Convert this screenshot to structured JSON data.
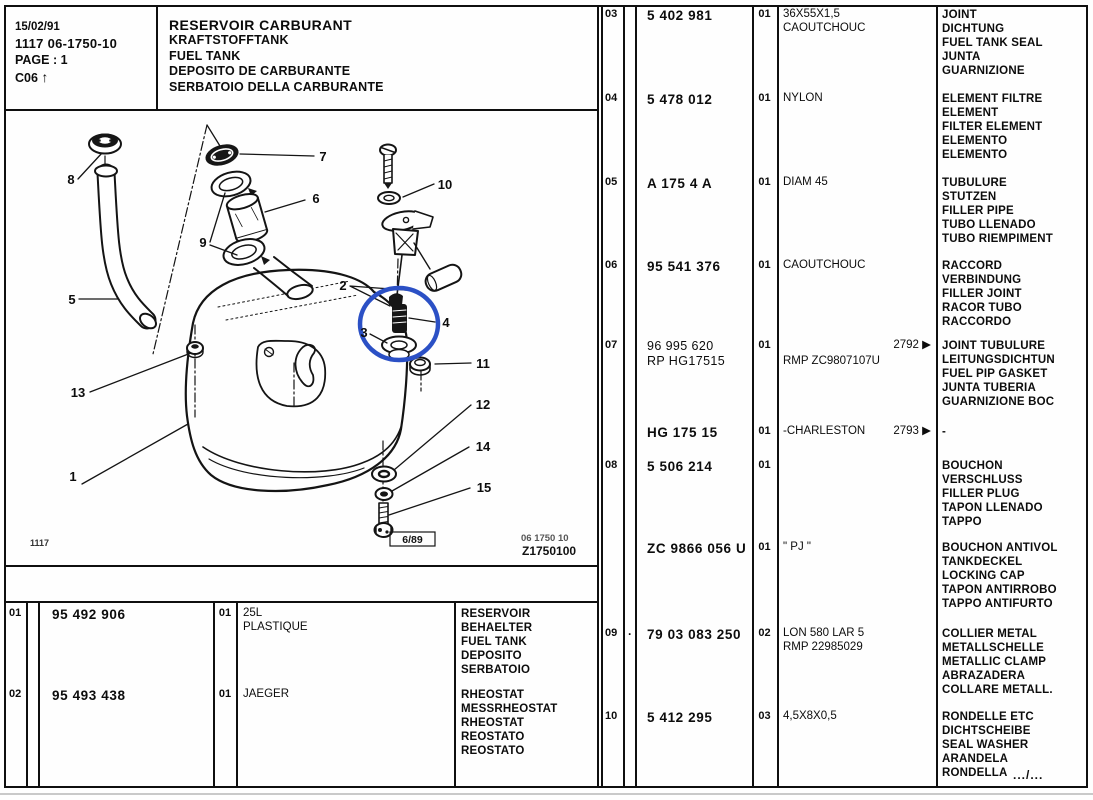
{
  "header": {
    "date": "15/02/91",
    "doc_number": "1117  06-1750-10",
    "page": "PAGE : 1",
    "section": "C06",
    "arrow": "↑"
  },
  "title_block": {
    "line1": "RESERVOIR CARBURANT",
    "line2": "KRAFTSTOFFTANK",
    "line3": "FUEL TANK",
    "line4": "DEPOSITO DE CARBURANTE",
    "line5": "SERBATOIO DELLA CARBURANTE"
  },
  "diagram": {
    "highlight_color": "#2b50c5",
    "callouts": [
      {
        "n": "1"
      },
      {
        "n": "2"
      },
      {
        "n": "3"
      },
      {
        "n": "4"
      },
      {
        "n": "5"
      },
      {
        "n": "6"
      },
      {
        "n": "7"
      },
      {
        "n": "8"
      },
      {
        "n": "9"
      },
      {
        "n": "10"
      },
      {
        "n": "11"
      },
      {
        "n": "12"
      },
      {
        "n": "13"
      },
      {
        "n": "14"
      },
      {
        "n": "15"
      }
    ],
    "footer": {
      "sheet_code": "1117",
      "revision": "6/89",
      "doc_ref_line1": "06 1750 10",
      "doc_ref_line2": "Z1750100"
    }
  },
  "parts_table_left": {
    "rows": [
      {
        "item": "01",
        "part": "95 492 906",
        "qty": "01",
        "spec": "25L\nPLASTIQUE",
        "names": "RESERVOIR\nBEHAELTER\nFUEL TANK\nDEPOSITO\nSERBATOIO"
      },
      {
        "item": "02",
        "part": "95 493 438",
        "qty": "01",
        "spec": "JAEGER",
        "names": "RHEOSTAT\nMESSRHEOSTAT\nRHEOSTAT\nREOSTATO\nREOSTATO"
      }
    ]
  },
  "parts_table_right": {
    "rows": [
      {
        "item": "03",
        "part": "5 402 981",
        "qty": "01",
        "spec": "36X55X1,5\nCAOUTCHOUC",
        "names": "JOINT\nDICHTUNG\nFUEL TANK SEAL\nJUNTA\nGUARNIZIONE"
      },
      {
        "item": "04",
        "part": "5 478 012",
        "qty": "01",
        "spec": "NYLON",
        "names": "ELEMENT FILTRE\nELEMENT\nFILTER ELEMENT\nELEMENTO\nELEMENTO"
      },
      {
        "item": "05",
        "part": "A 175 4 A",
        "qty": "01",
        "spec": "DIAM 45",
        "names": "TUBULURE\nSTUTZEN\nFILLER PIPE\nTUBO LLENADO\nTUBO RIEMPIMENT"
      },
      {
        "item": "06",
        "part": "95 541 376",
        "qty": "01",
        "spec": "CAOUTCHOUC",
        "names": "RACCORD\nVERBINDUNG\nFILLER JOINT\nRACOR TUBO\nRACCORDO"
      },
      {
        "item": "07",
        "part": "96 995 620\nRP  HG17515",
        "qty": "01",
        "spec": "RMP ZC9807107U",
        "spec_note": "2792 ▶",
        "names": "JOINT TUBULURE\nLEITUNGSDICHTUN\nFUEL PIP GASKET\nJUNTA TUBERIA\nGUARNIZIONE BOC"
      },
      {
        "item": "",
        "part": "HG 175 15",
        "qty": "01",
        "spec": "-CHARLESTON",
        "spec_note": "2793 ▶",
        "names": "-"
      },
      {
        "item": "08",
        "part": "5 506 214",
        "qty": "01",
        "spec": "",
        "names": "BOUCHON\nVERSCHLUSS\nFILLER PLUG\nTAPON LLENADO\nTAPPO"
      },
      {
        "item": "",
        "part": "ZC 9866 056 U",
        "qty": "01",
        "spec": "\" PJ \"",
        "names": "BOUCHON ANTIVOL\nTANKDECKEL\nLOCKING CAP\nTAPON ANTIRROBO\nTAPPO ANTIFURTO"
      },
      {
        "item": "09",
        "marker": "·",
        "part": "79 03 083 250",
        "qty": "02",
        "spec": "LON 580 LAR 5\nRMP 22985029",
        "names": "COLLIER METAL\nMETALLSCHELLE\nMETALLIC CLAMP\nABRAZADERA\nCOLLARE METALL."
      },
      {
        "item": "10",
        "part": "5 412 295",
        "qty": "03",
        "spec": "4,5X8X0,5",
        "names": "RONDELLE ETC\nDICHTSCHEIBE\nSEAL WASHER\nARANDELA\nRONDELLA",
        "continuation": ".../..."
      }
    ]
  }
}
